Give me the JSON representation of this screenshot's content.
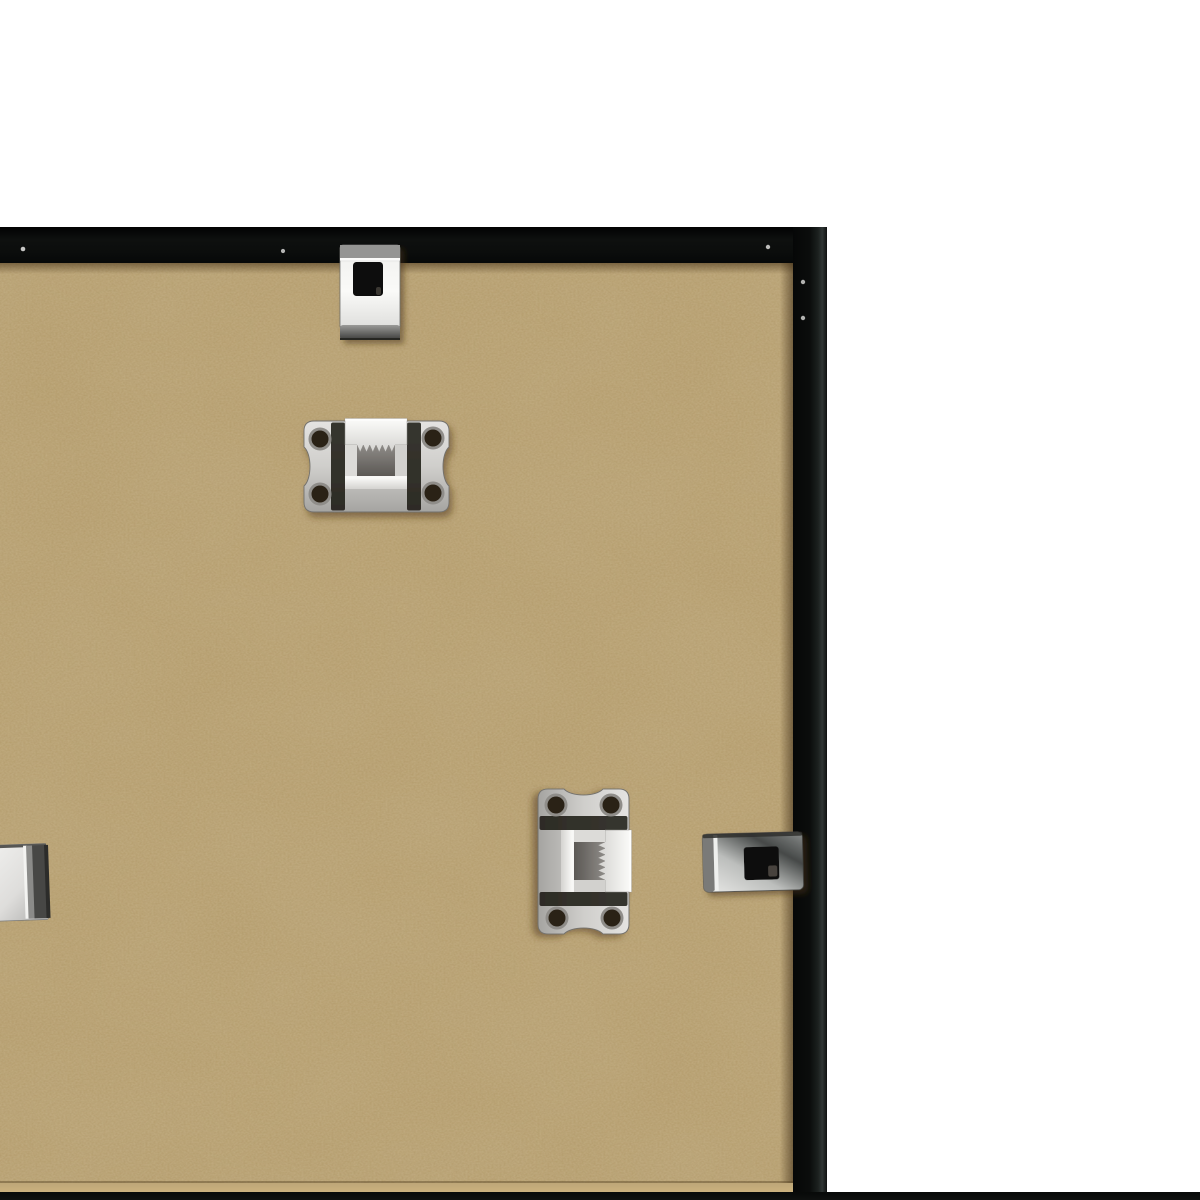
{
  "scene": {
    "description": "Back view of the top-right corner of a black picture frame: tan MDF backing board held by metal hardware, photographed on a white background",
    "photo_label": "picture frame back with hanging hardware",
    "frame": {
      "label": "black frame moulding",
      "color": "#0b0d0c"
    },
    "backing": {
      "label": "MDF backing board",
      "color": "#b29968"
    },
    "background": {
      "label": "white studio background",
      "color": "#ffffff"
    },
    "hardware": [
      {
        "name": "spring-clip-top",
        "label": "metal spring clip over top rail"
      },
      {
        "name": "sawtooth-hanger-horizontal",
        "label": "sawtooth hanger plate, horizontal, four holes"
      },
      {
        "name": "sawtooth-hanger-vertical",
        "label": "sawtooth hanger plate, vertical, four holes"
      },
      {
        "name": "spring-clip-right",
        "label": "metal spring clip over right rail"
      },
      {
        "name": "spring-clip-left-partial",
        "label": "metal clip at left image edge, partially visible"
      },
      {
        "name": "staple-dots",
        "label": "small bright staples on frame moulding"
      }
    ],
    "colors": {
      "metal_bright": "#f4f4f2",
      "metal_mid": "#b9b9b7",
      "metal_dark": "#3c3c3a",
      "frame_black": "#0b0d0c",
      "mdf_tan": "#b29968",
      "white": "#ffffff"
    }
  }
}
